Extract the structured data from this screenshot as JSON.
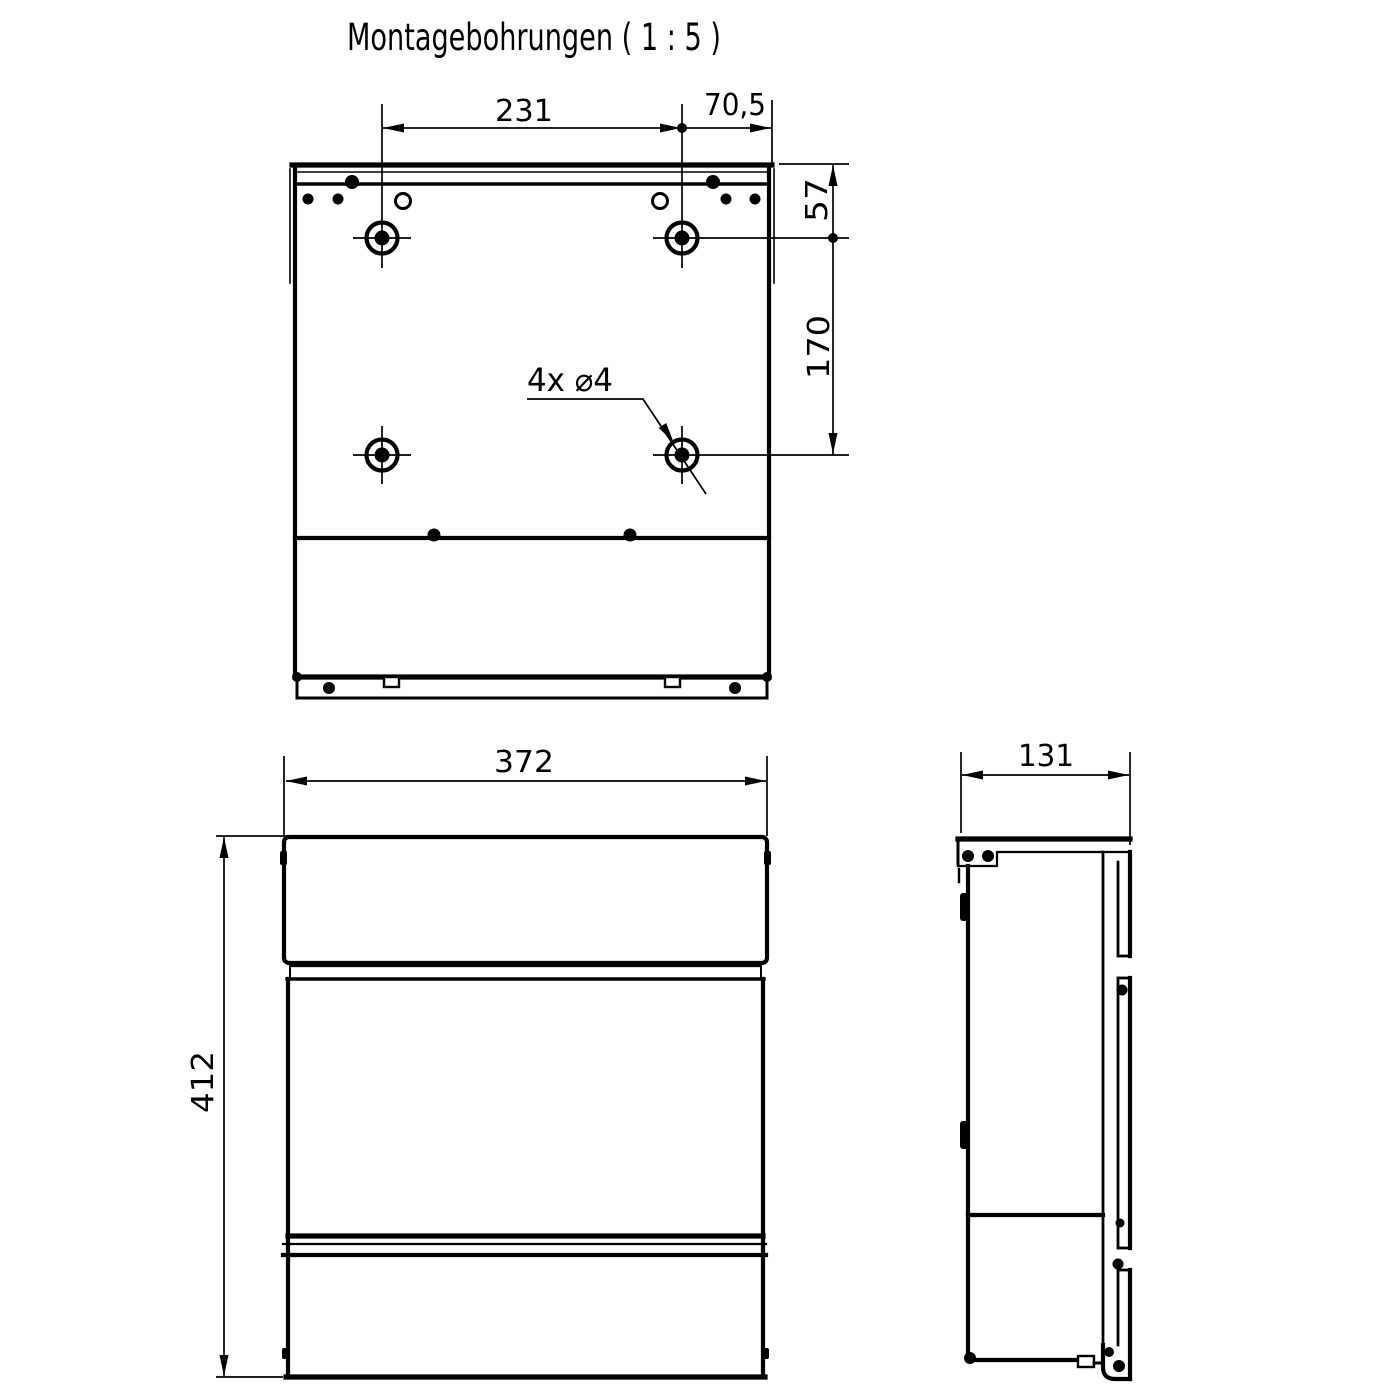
{
  "drawing": {
    "title": "Montagebohrungen ( 1 : 5 )",
    "line_color": "#000000",
    "background_color": "#ffffff"
  },
  "rear_view": {
    "dim_hole_spacing_horizontal": "231",
    "dim_hole_to_edge": "70,5",
    "dim_top_edge_to_holes": "57",
    "dim_hole_spacing_vertical": "170",
    "hole_callout": "4x ⌀4"
  },
  "front_view": {
    "dim_width": "372",
    "dim_height": "412"
  },
  "side_view": {
    "dim_depth": "131"
  }
}
